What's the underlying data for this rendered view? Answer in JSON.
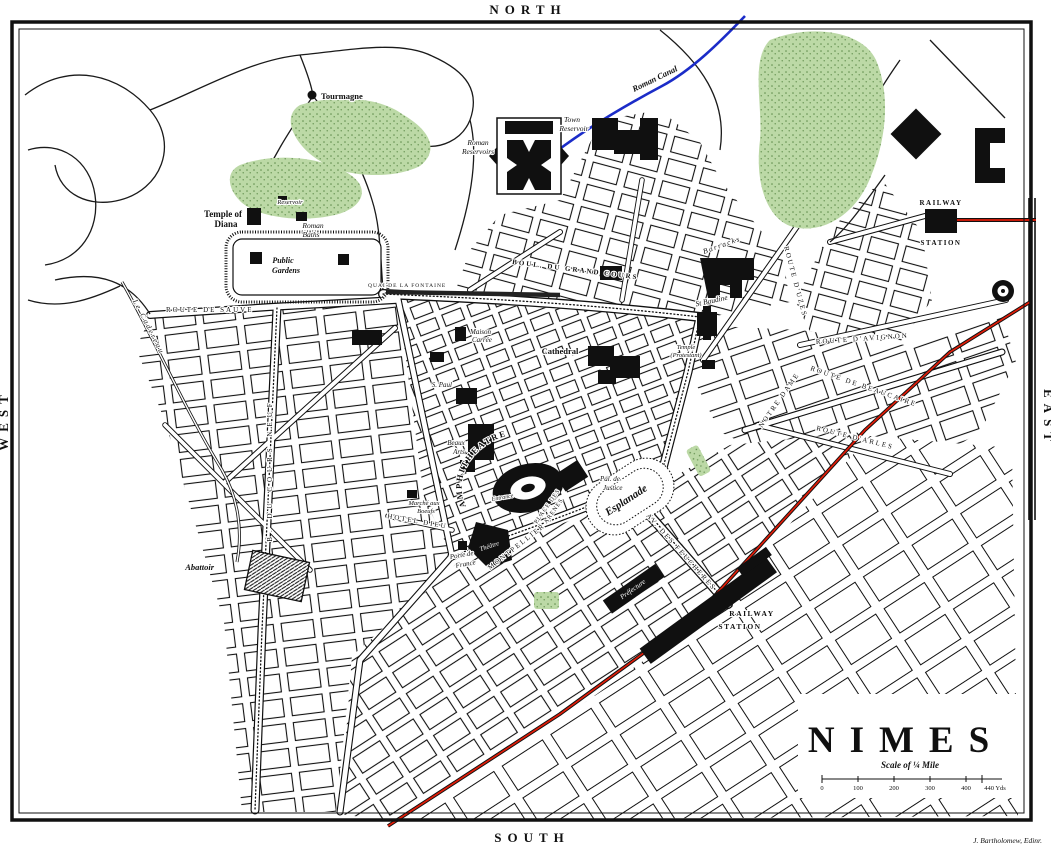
{
  "map_name": "Plan of Nimes",
  "colors": {
    "ink": "#101010",
    "paper": "#ffffff",
    "park_green": "#bcd9a6",
    "park_dot": "#5f8c4b",
    "railway_red": "#e01c08",
    "canal_blue": "#1b2cc8",
    "water_dark": "#222222"
  },
  "compass": {
    "north": "NORTH",
    "south": "SOUTH",
    "west": "WEST",
    "east": "EAST"
  },
  "title_block": {
    "title": "NIMES",
    "scale_label": "Scale of ¼ Mile",
    "scale_ticks": [
      "0",
      "100",
      "200",
      "300",
      "400",
      "440 Yds"
    ],
    "credit": "J. Bartholomew, Edinr."
  },
  "labels": {
    "tourmagne": "Tourmagne",
    "temple_of_diana_1": "Temple of",
    "temple_of_diana_2": "Diana",
    "reservoir": "Reservoir",
    "roman_baths_1": "Roman",
    "roman_baths_2": "Baths",
    "public_gardens_1": "Public",
    "public_gardens_2": "Gardens",
    "quai_fontaine": "QUAI DE LA FONTAINE",
    "route_sauve": "ROUTE DE SAUVE",
    "cadereau": "Le Cadereau",
    "cours_neuf": "B. DU COURS NEUF",
    "roman_reservoirs_1": "Roman",
    "roman_reservoirs_2": "Reservoirs",
    "town_reservoir_1": "Town",
    "town_reservoir_2": "Reservoir",
    "roman_canal": "Roman Canal",
    "grand_cours": "BOUL. DU GRAND COURS",
    "barracks": "Barracks",
    "st_baudile": "St Baudine",
    "temple_protestant_1": "Temple",
    "temple_protestant_2": "(Protestant)",
    "route_uzes": "ROUTE D'UZES",
    "route_avignon": "ROUTE D'AVIGNON",
    "route_beaucaire": "ROUTE DE BEAUCAIRE",
    "route_arles": "ROUTE D'ARLES",
    "notre_dame": "NOTRE DAME",
    "maison_carree_1": "Maison",
    "maison_carree_2": "Carrée",
    "cathedral": "Cathedral",
    "s_paul": "S. Paul",
    "beaux_arts_1": "Beaux",
    "beaux_arts_2": "Arts",
    "amphitheatre": "AMPHITHEATRE",
    "entrance": "Entrance",
    "place_des_arenes_1": "PLACE DES",
    "place_des_arenes_2": "ARENES",
    "pal_justice_1": "Pal. de",
    "pal_justice_2": "Justice",
    "esplanade": "Esplanade",
    "theatre": "Théâtre",
    "porte_france_1": "Porte de",
    "porte_france_2": "France",
    "marche_1": "Marché aux",
    "marche_2": "Boeufs",
    "hotel_dieu": "HOTEL DIEU",
    "montpellier": "MONTPELLIER",
    "feucheres": "AV. DES FEUCHERES",
    "abattoir": "Abattoir",
    "prefecture": "Préfecture",
    "station_central_1": "RAILWAY",
    "station_central_2": "STATION",
    "station_ne_1": "RAILWAY",
    "station_ne_2": "STATION"
  }
}
